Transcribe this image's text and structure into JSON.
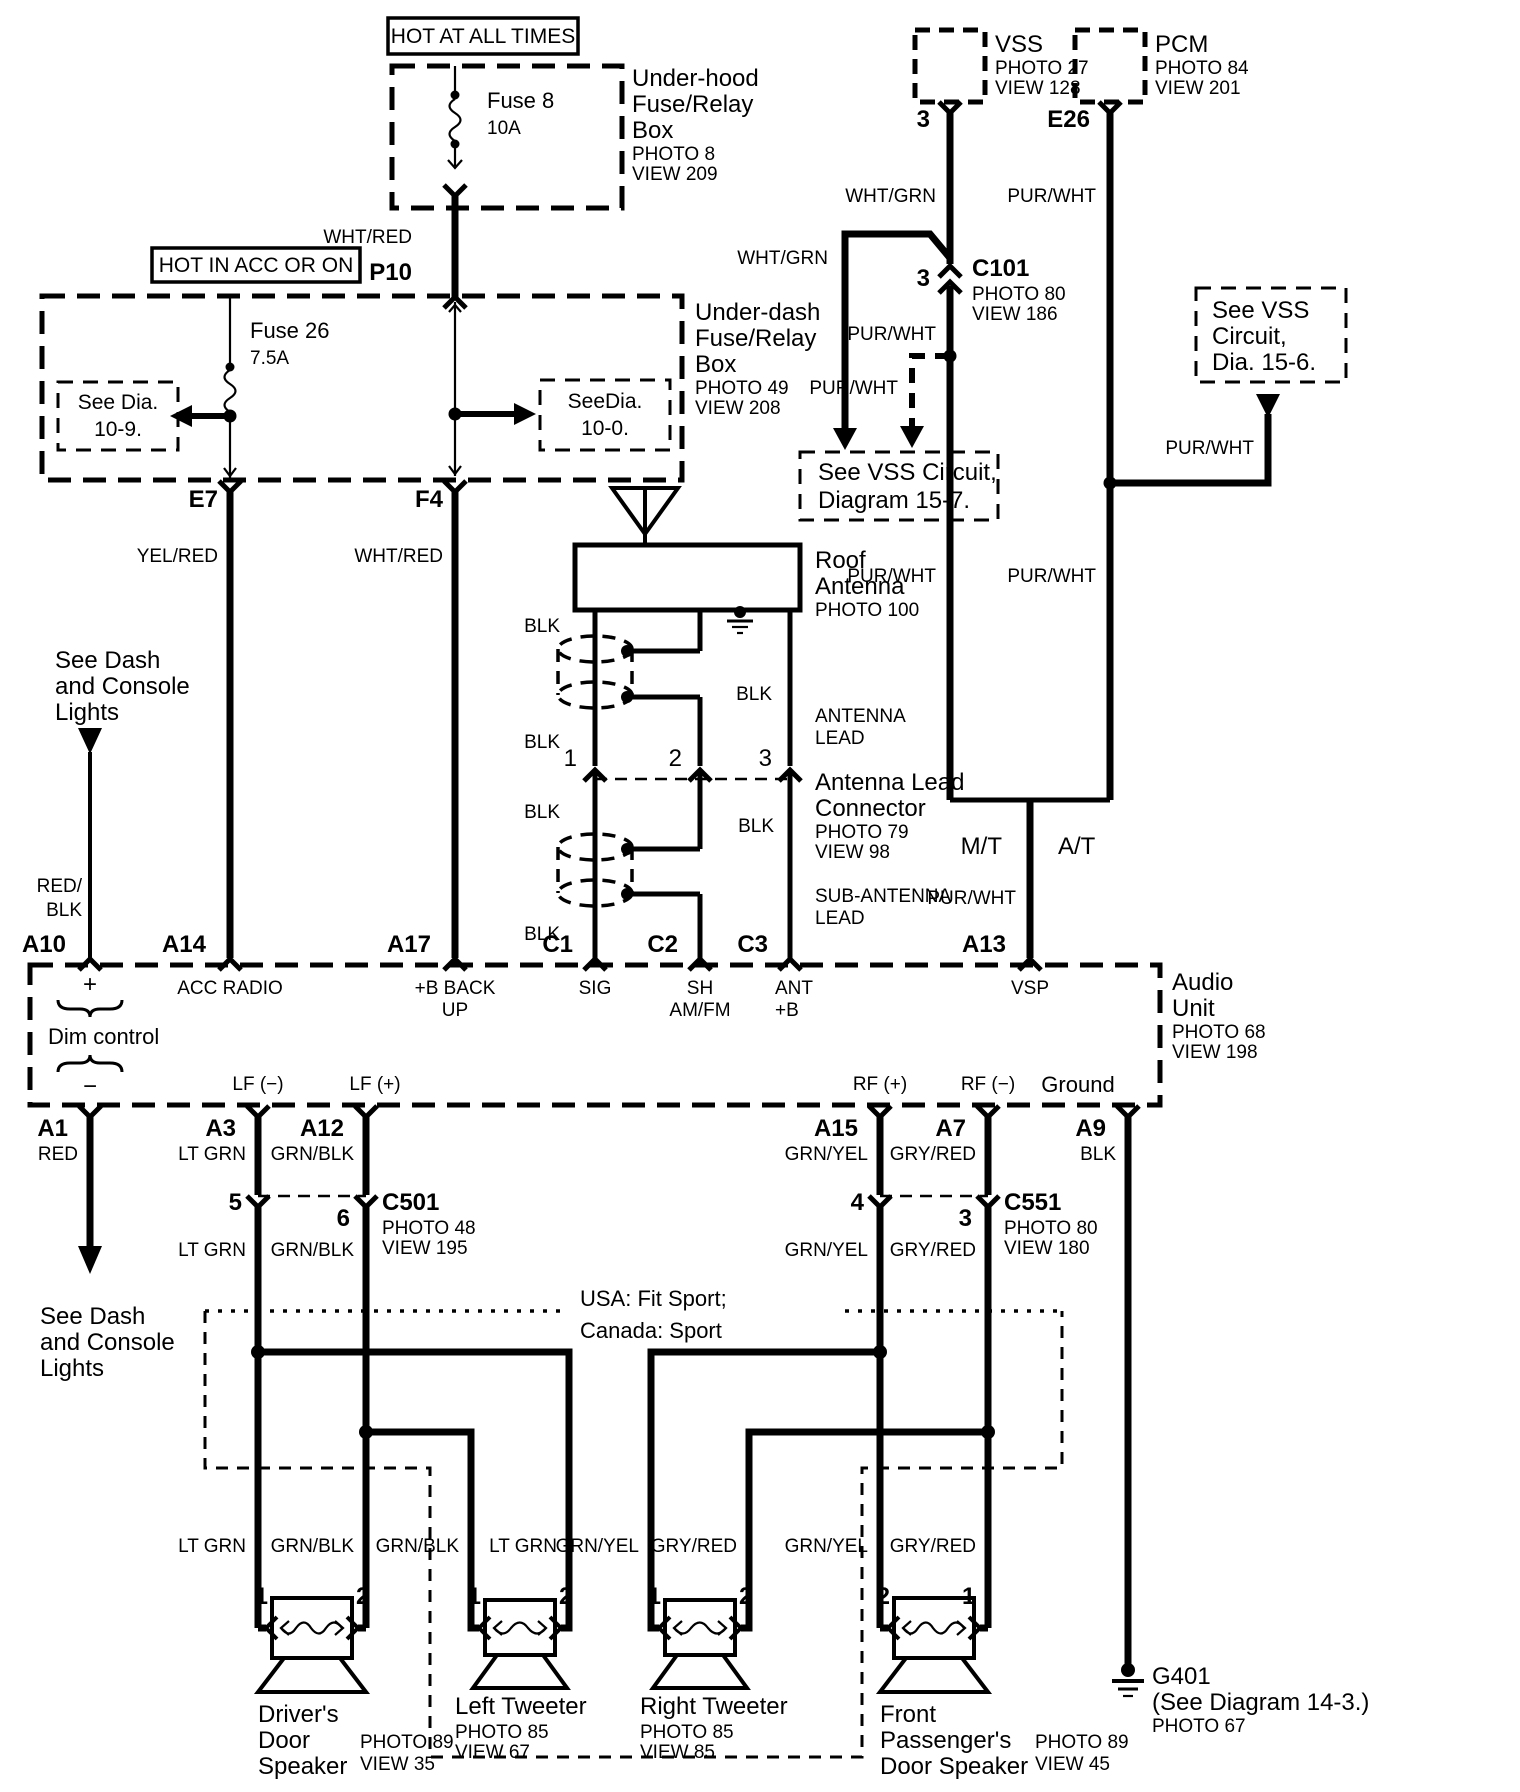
{
  "colors": {
    "ink": "#000000",
    "paper": "#ffffff"
  },
  "banners": {
    "hot_all_times": "HOT AT ALL TIMES",
    "hot_acc_on": "HOT IN ACC OR ON"
  },
  "underhood": {
    "l1": "Under-hood",
    "l2": "Fuse/Relay",
    "l3": "Box",
    "photo": "PHOTO 8",
    "view": "VIEW 209",
    "fuse": "Fuse 8",
    "amp": "10A"
  },
  "underdash": {
    "l1": "Under-dash",
    "l2": "Fuse/Relay",
    "l3": "Box",
    "photo": "PHOTO 49",
    "view": "VIEW 208",
    "fuse": "Fuse 26",
    "amp": "7.5A",
    "dia_left1": "See Dia.",
    "dia_left2": "10-9.",
    "dia_right1": "SeeDia.",
    "dia_right2": "10-0."
  },
  "wire": {
    "wht_red": "WHT/RED",
    "yel_red": "YEL/RED",
    "wht_grn": "WHT/GRN",
    "pur_wht": "PUR/WHT",
    "blk": "BLK",
    "red": "RED",
    "red_slash": "RED/",
    "lt_grn": "LT GRN",
    "grn_blk": "GRN/BLK",
    "grn_yel": "GRN/YEL",
    "gry_red": "GRY/RED"
  },
  "conn": {
    "p10": "P10",
    "e7": "E7",
    "f4": "F4",
    "c101": {
      "name": "C101",
      "photo": "PHOTO 80",
      "view": "VIEW 186",
      "pin": "3"
    },
    "c501": {
      "name": "C501",
      "photo": "PHOTO 48",
      "view": "VIEW 195",
      "pin_a": "5",
      "pin_b": "6"
    },
    "c551": {
      "name": "C551",
      "photo": "PHOTO 80",
      "view": "VIEW 180",
      "pin_a": "4",
      "pin_b": "3"
    }
  },
  "vss": {
    "name": "VSS",
    "photo": "PHOTO 27",
    "view": "VIEW 128",
    "pin": "3"
  },
  "pcm": {
    "name": "PCM",
    "photo": "PHOTO 84",
    "view": "VIEW 201",
    "pin": "E26"
  },
  "vss_circuit_157": {
    "l1": "See VSS Circuit,",
    "l2": "Diagram 15-7."
  },
  "vss_circuit_156": {
    "l1": "See VSS",
    "l2": "Circuit,",
    "l3": "Dia. 15-6."
  },
  "trans": {
    "mt": "M/T",
    "at": "A/T"
  },
  "roof_antenna": {
    "l1": "Roof",
    "l2": "Antenna",
    "photo": "PHOTO 100"
  },
  "antenna_lead": {
    "l1": "ANTENNA",
    "l2": "LEAD"
  },
  "antenna_conn": {
    "l1": "Antenna Lead",
    "l2": "Connector",
    "photo": "PHOTO 79",
    "view": "VIEW 98",
    "pin1": "1",
    "pin2": "2",
    "pin3": "3"
  },
  "sub_antenna": {
    "l1": "SUB-ANTENNA",
    "l2": "LEAD"
  },
  "see_dash": {
    "l1": "See Dash",
    "l2": "and Console",
    "l3": "Lights"
  },
  "audio_unit": {
    "l1": "Audio",
    "l2": "Unit",
    "photo": "PHOTO 68",
    "view": "VIEW 198",
    "pins_top": {
      "a10": "A10",
      "a14": "A14",
      "a17": "A17",
      "c1": "C1",
      "c2": "C2",
      "c3": "C3",
      "a13": "A13"
    },
    "pins_bottom": {
      "a1": "A1",
      "a3": "A3",
      "a12": "A12",
      "a15": "A15",
      "a7": "A7",
      "a9": "A9"
    },
    "fn": {
      "plus": "+",
      "minus": "−",
      "dim": "Dim control",
      "acc": "ACC RADIO",
      "backup1": "+B BACK",
      "backup2": "UP",
      "sig": "SIG",
      "sh1": "SH",
      "sh2": "AM/FM",
      "ant1": "ANT",
      "ant2": "+B",
      "vsp": "VSP",
      "lf_minus": "LF (−)",
      "lf_plus": "LF (+)",
      "rf_plus": "RF (+)",
      "rf_minus": "RF (−)",
      "ground": "Ground"
    }
  },
  "sport": {
    "l1": "USA: Fit Sport;",
    "l2": "Canada: Sport"
  },
  "speakers": {
    "driver": {
      "l1": "Driver's",
      "l2": "Door",
      "l3": "Speaker",
      "photo": "PHOTO 89",
      "view": "VIEW 35",
      "pin_l": "1",
      "pin_r": "2"
    },
    "tw_left": {
      "l1": "Left Tweeter",
      "photo": "PHOTO 85",
      "view": "VIEW 67",
      "pin_l": "1",
      "pin_r": "2"
    },
    "tw_right": {
      "l1": "Right Tweeter",
      "photo": "PHOTO 85",
      "view": "VIEW 85",
      "pin_l": "1",
      "pin_r": "2"
    },
    "passenger": {
      "l1": "Front",
      "l2": "Passenger's",
      "l3": "Door Speaker",
      "photo": "PHOTO 89",
      "view": "VIEW 45",
      "pin_l": "2",
      "pin_r": "1"
    }
  },
  "g401": {
    "name": "G401",
    "ref": "(See Diagram 14-3.)",
    "photo": "PHOTO 67"
  }
}
